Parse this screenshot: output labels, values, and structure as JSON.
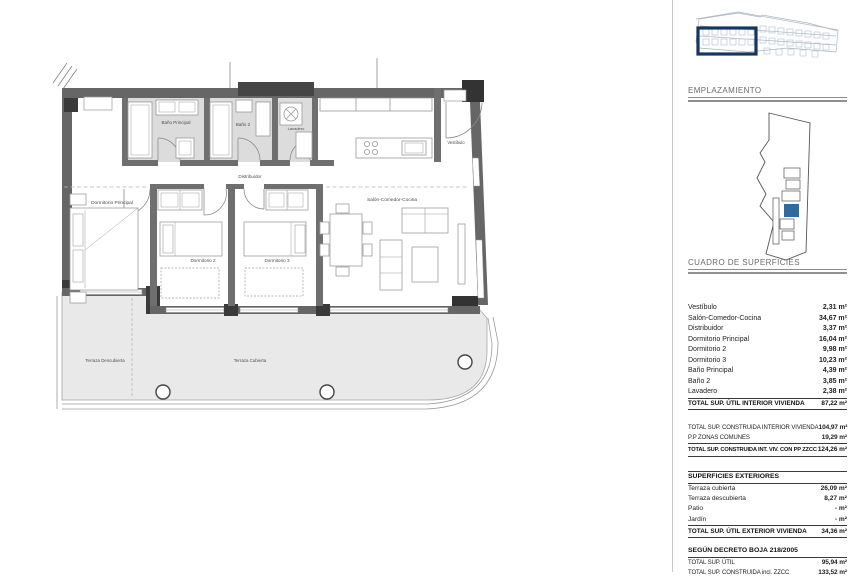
{
  "plan": {
    "labels": {
      "bano_principal": "Baño Principal",
      "bano_2": "Baño 2",
      "lavadero": "Lavadero",
      "vestibulo": "Vestíbulo",
      "distribuidor": "Distribuidor",
      "dormitorio_principal": "Dormitorio Principal",
      "dormitorio_2": "Dormitorio 2",
      "dormitorio_3": "Dormitorio 3",
      "salon": "Salón-Comedor-Cocina",
      "terraza_descubierta": "Terraza Descubierta",
      "terraza_cubierta": "Terraza Cubierta"
    }
  },
  "panel": {
    "emplazamiento_title": "EMPLAZAMIENTO",
    "cuadro_title": "CUADRO DE SUPERFICIES",
    "interior": {
      "rows": [
        {
          "label": "Vestíbulo",
          "value": "2,31 m²"
        },
        {
          "label": "Salón-Comedor-Cocina",
          "value": "34,67 m²"
        },
        {
          "label": "Distribuidor",
          "value": "3,37 m²"
        },
        {
          "label": "Dormitorio Principal",
          "value": "16,04 m²"
        },
        {
          "label": "Dormitorio 2",
          "value": "9,98 m²"
        },
        {
          "label": "Dormitorio 3",
          "value": "10,23 m²"
        },
        {
          "label": "Baño Principal",
          "value": "4,39 m²"
        },
        {
          "label": "Baño 2",
          "value": "3,85 m²"
        },
        {
          "label": "Lavadero",
          "value": "2,38 m²"
        }
      ],
      "total": {
        "label": "TOTAL SUP. ÚTIL INTERIOR VIVIENDA",
        "value": "87,22 m²"
      }
    },
    "construida": {
      "rows": [
        {
          "label": "TOTAL SUP. CONSTRUIDA INTERIOR VIVIENDA",
          "value": "104,97 m²"
        },
        {
          "label": "P.P ZONAS COMUNES",
          "value": "19,29 m²"
        }
      ],
      "total": {
        "label": "TOTAL SUP. CONSTRUIDA INT. VIV. CON PP ZZCC",
        "value": "124,26 m²"
      }
    },
    "exteriores": {
      "title": "SUPERFICIES EXTERIORES",
      "rows": [
        {
          "label": "Terraza cubierta",
          "value": "26,09 m²"
        },
        {
          "label": "Terraza descubierta",
          "value": "8,27 m²"
        },
        {
          "label": "Patio",
          "value": "- m²"
        },
        {
          "label": "Jardín",
          "value": "- m²"
        }
      ],
      "total": {
        "label": "TOTAL SUP. ÚTIL EXTERIOR VIVIENDA",
        "value": "34,36 m²"
      }
    },
    "decreto": {
      "title": "SEGÚN DECRETO BOJA 218/2005",
      "rows": [
        {
          "label": "TOTAL SUP. ÚTIL",
          "value": "95,94 m²"
        },
        {
          "label": "TOTAL SUP. CONSTRUIDA incl. ZZCC",
          "value": "133,52 m²"
        }
      ]
    }
  },
  "colors": {
    "highlight_box": "#17365d",
    "unit_fill": "#2f6b9f",
    "wall": "#666666",
    "terrace_fill": "#e9e9e9"
  }
}
